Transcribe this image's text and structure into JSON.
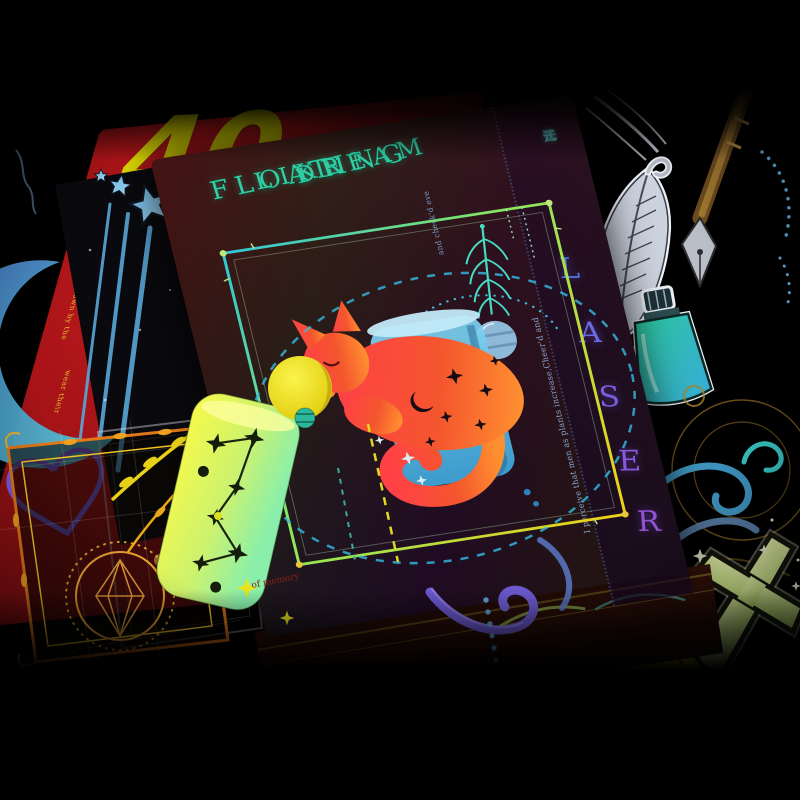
{
  "photo": {
    "subject": "holographic laser sticker sheets, magic theme product photo",
    "palette": {
      "background": "#000000",
      "red_card": "#b5161a",
      "title_teal": "#2fd0a6",
      "laser_purple": "#7a5ce4",
      "magic_gradient": [
        "#2fb4ac",
        "#3f86dc",
        "#7a5ae8"
      ],
      "cat_gradient": [
        "#ff4146",
        "#ff9030"
      ],
      "sun_yellow": "#f0e41e",
      "cylinder_green": [
        "#f6fa48",
        "#8aefaa"
      ],
      "glass_blue": "#5ac8ec",
      "moon_blue": "#4878c8",
      "ink_teal": "#2cc89c",
      "book_yellow": "#ead818",
      "cross_green": "#cfe49a",
      "frame_orange": "#e07818",
      "feather_silver": "#ccd2de",
      "pen_bronze": "#8a6428"
    }
  },
  "red_card": {
    "number": "40",
    "flip_text": "in their yo",
    "ring_text": "ful sap at heig",
    "edge_texts": [
      "down by the",
      "wear their"
    ]
  },
  "main_card": {
    "title_lines": [
      "FLOATING",
      "LIKE",
      "DREAM"
    ],
    "vertical_cjk": [
      "法",
      "光",
      "芒"
    ],
    "sonnet_text": "I perceive that men as plants increase,Cheer'd and",
    "sonnet_text_2": "and check'd eve",
    "memory_text": "of memory",
    "laser_letters": [
      "L",
      "A",
      "S",
      "E",
      "R"
    ],
    "brand": {
      "word1": "MAGIC",
      "word2": "LIGHT"
    }
  },
  "stickers": {
    "left": [
      "shooting-stars",
      "crescent-moon",
      "heart-outline",
      "ornate-frame",
      "gem-emblem",
      "tarot-frame"
    ],
    "right": [
      "quill-feather",
      "dip-pen",
      "ink-bottle",
      "gold-circles",
      "swirl-flourishes",
      "cross",
      "spellbook-triquetra"
    ],
    "center": [
      "sleeping-cat",
      "glass-cup",
      "sun",
      "constellation-cylinder",
      "striped-planet",
      "leaf-ornament",
      "dashed-orbit",
      "star-ring"
    ]
  }
}
